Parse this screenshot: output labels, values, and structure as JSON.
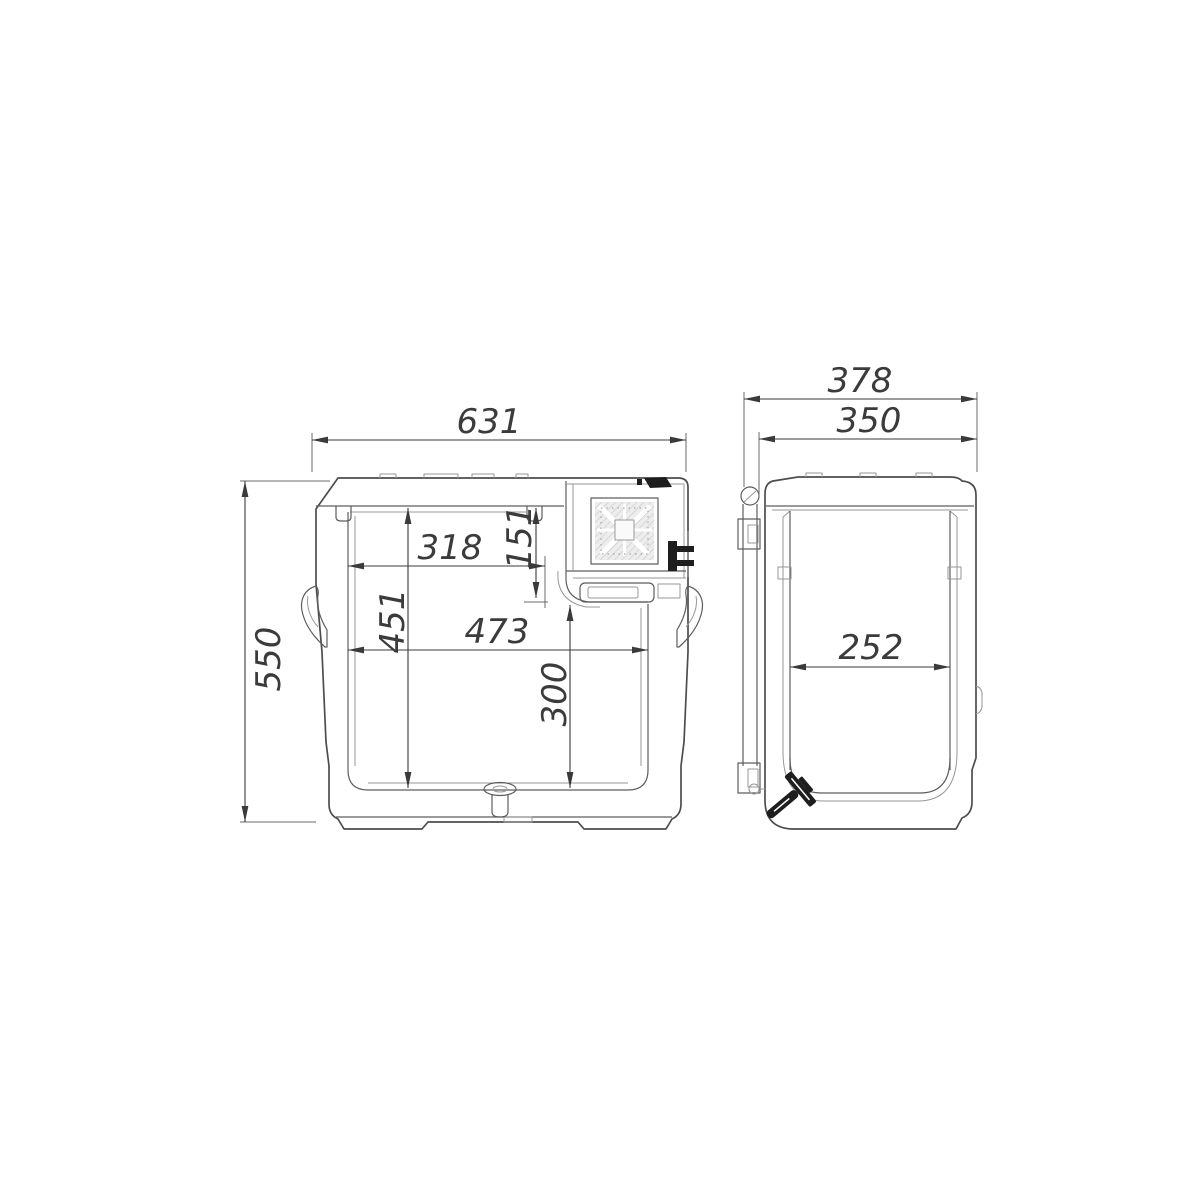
{
  "colors": {
    "background": "#ffffff",
    "outline": "#4d4d4d",
    "detail_light": "#979797",
    "dimension": "#3a3a3a",
    "dark_fill": "#1e1e1e",
    "grille_hatch": "#ededed"
  },
  "front_view": {
    "dims": {
      "overall_width": "631",
      "overall_height": "550",
      "top_interior_width": "318",
      "compressor_recess_depth": "151",
      "interior_depth": "451",
      "interior_width": "473",
      "lower_interior_depth": "300"
    }
  },
  "side_view": {
    "dims": {
      "overall_depth": "378",
      "body_depth": "350",
      "interior_width": "252"
    }
  }
}
